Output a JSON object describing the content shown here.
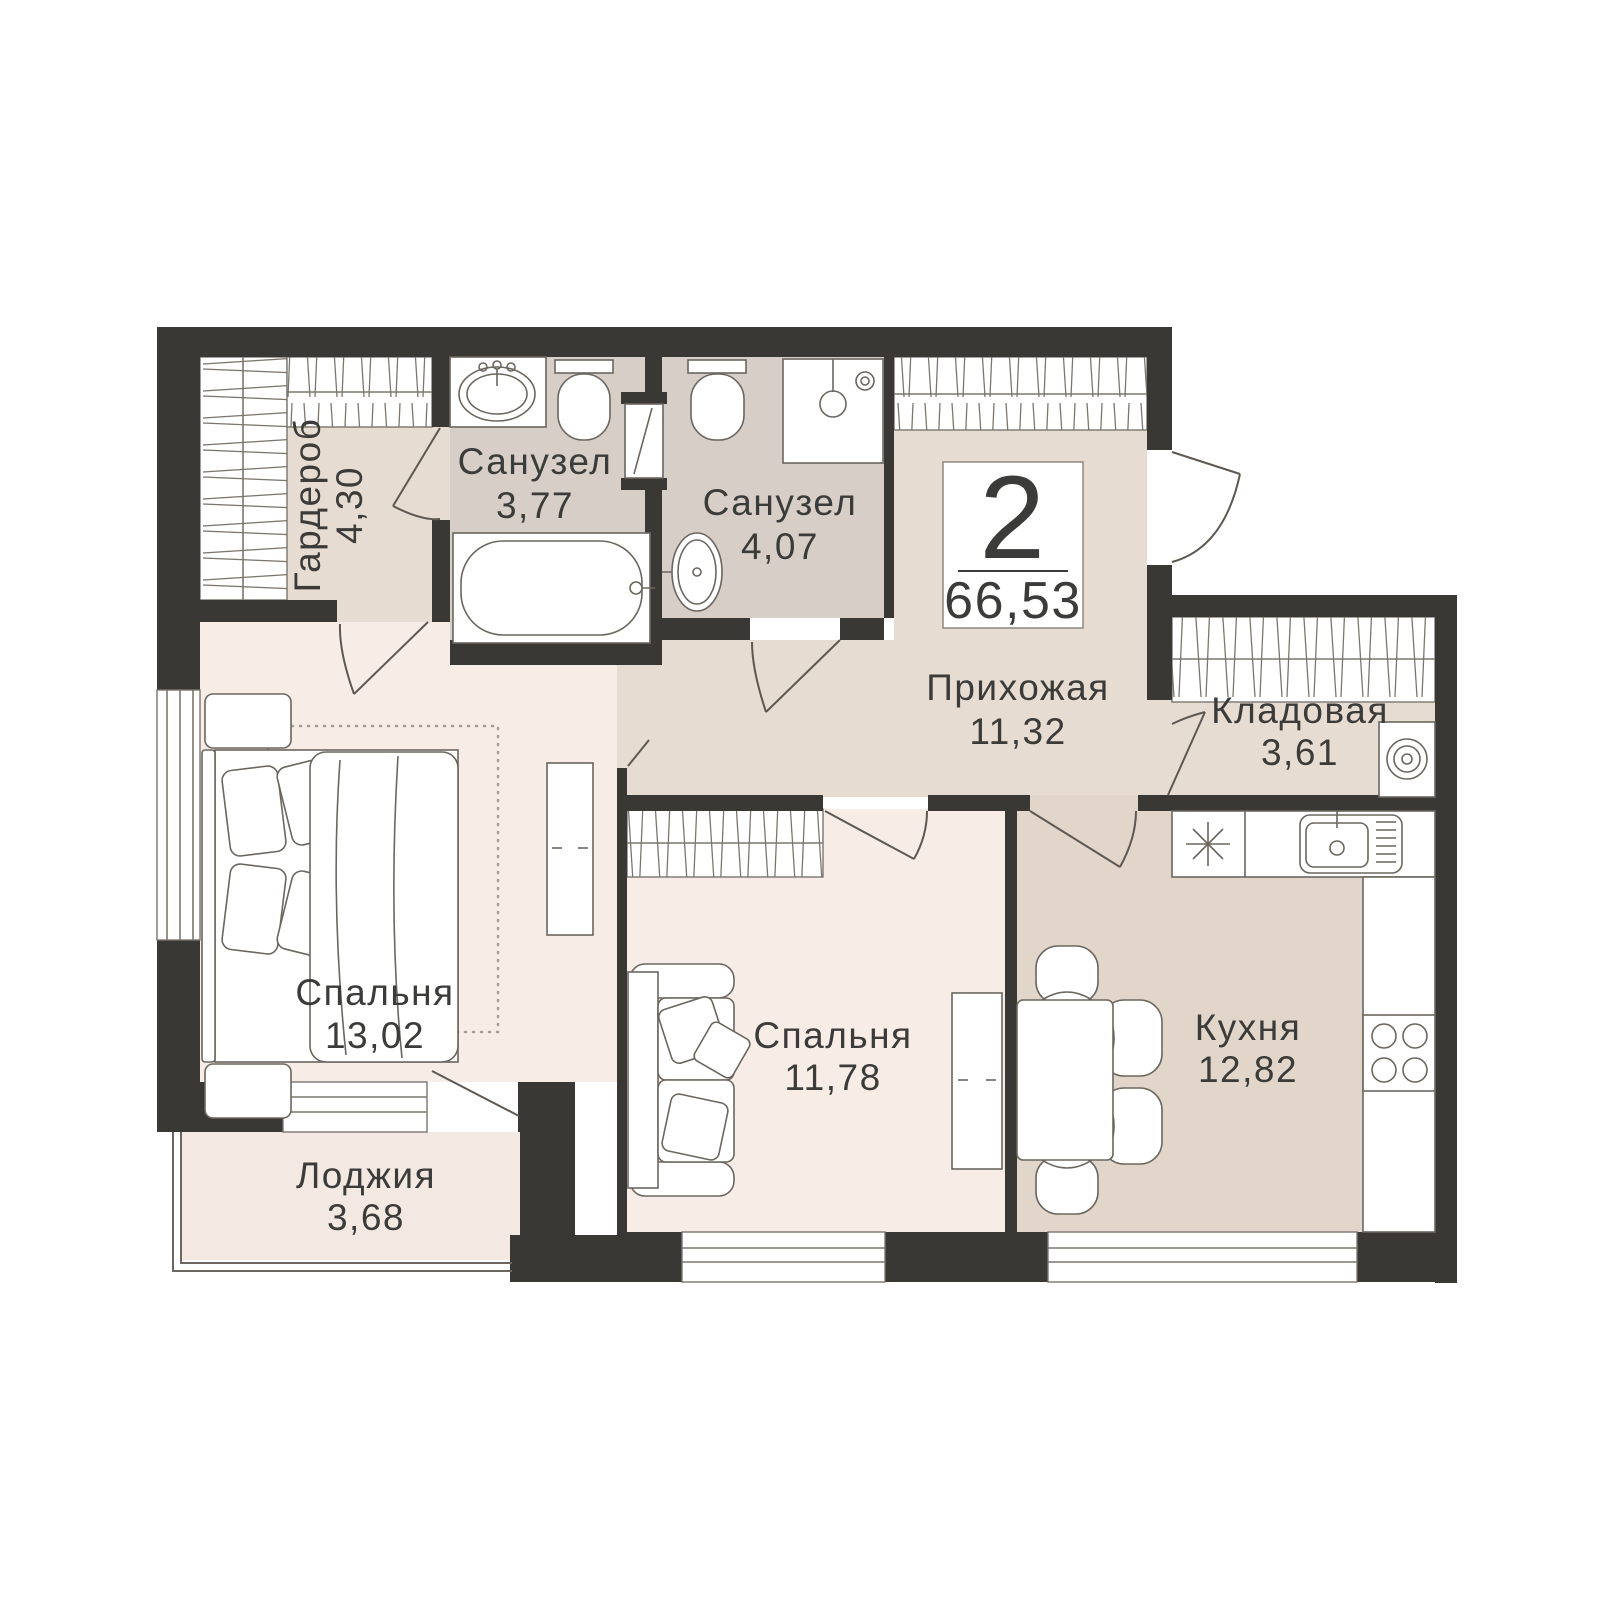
{
  "badge": {
    "rooms_count": "2",
    "total_area": "66,53"
  },
  "rooms": [
    {
      "id": "wardrobe",
      "name": "Гардероб",
      "area": "4,30"
    },
    {
      "id": "bathroom_1",
      "name": "Санузел",
      "area": "3,77"
    },
    {
      "id": "bathroom_2",
      "name": "Санузел",
      "area": "4,07"
    },
    {
      "id": "hallway",
      "name": "Прихожая",
      "area": "11,32"
    },
    {
      "id": "storage",
      "name": "Кладовая",
      "area": "3,61"
    },
    {
      "id": "bedroom_1",
      "name": "Спальня",
      "area": "13,02"
    },
    {
      "id": "bedroom_2",
      "name": "Спальня",
      "area": "11,78"
    },
    {
      "id": "kitchen",
      "name": "Кухня",
      "area": "12,82"
    },
    {
      "id": "loggia",
      "name": "Лоджия",
      "area": "3,68"
    }
  ],
  "colors": {
    "wall": "#3a3835",
    "room_light": "#f7ece6",
    "room_taupe": "#e7dcd2",
    "room_bath": "#d6cec7",
    "room_kitchen": "#e2d6cb",
    "loggia": "#f3e8e2",
    "background": "#ffffff"
  }
}
